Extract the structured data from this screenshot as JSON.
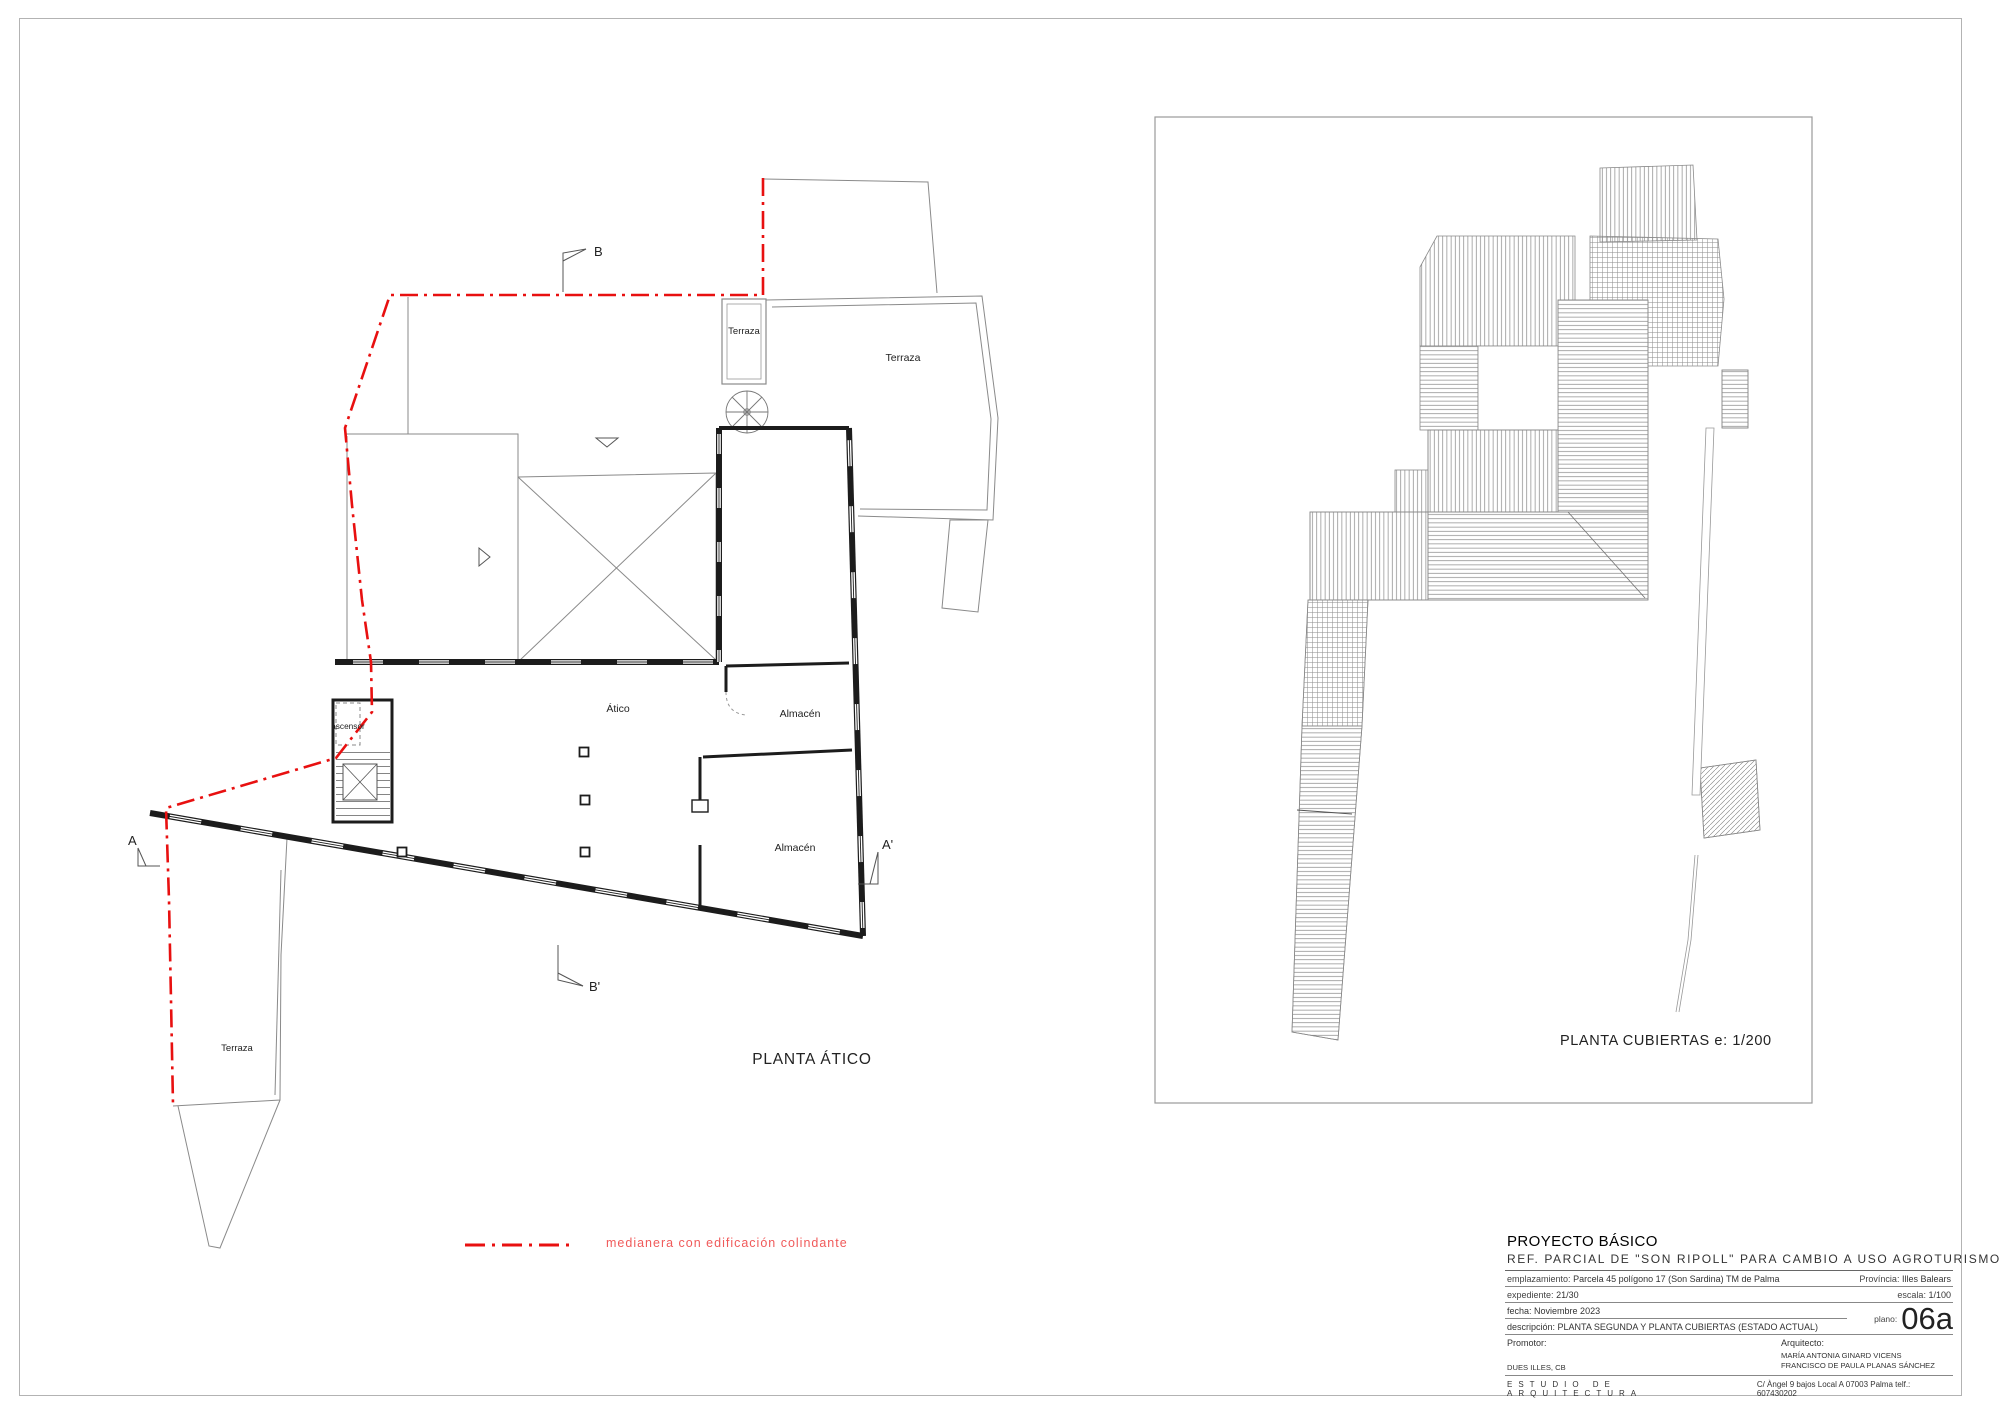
{
  "plan_atico": {
    "title": "PLANTA ÁTICO",
    "labels": {
      "terraza_top": "Terraza",
      "terraza_right": "Terraza",
      "atico": "Ático",
      "almacen_upper": "Almacén",
      "almacen_lower": "Almacén",
      "ascensor": "ascensor",
      "terraza_bottom": "Terraza"
    },
    "section_markers": {
      "a": "A",
      "a_prime": "A'",
      "b": "B",
      "b_prime": "B'"
    }
  },
  "plan_cubiertas": {
    "title": "PLANTA CUBIERTAS  e: 1/200"
  },
  "legend": {
    "label": "medianera con edificación colindante"
  },
  "colors": {
    "boundary_red": "#e81010",
    "legend_text": "#f05a5a"
  },
  "title_block": {
    "project_type": "PROYECTO BÁSICO",
    "project_ref": "REF. PARCIAL DE \"SON RIPOLL\" PARA CAMBIO A USO AGROTURISMO",
    "emplazamiento_label": "emplazamiento:",
    "emplazamiento": "Parcela 45 polígono 17  (Son Sardina) TM de Palma",
    "provincia_label": "Província:",
    "provincia": "Illes Balears",
    "expediente_label": "expediente:",
    "expediente": "21/30",
    "escala_label": "escala:",
    "escala": "1/100",
    "fecha_label": "fecha:",
    "fecha": "Noviembre 2023",
    "descripcion_label": "descripción:",
    "descripcion": "PLANTA SEGUNDA Y PLANTA CUBIERTAS (ESTADO ACTUAL)",
    "plano_label": "plano:",
    "plano": "06a",
    "promotor_label": "Promotor:",
    "promotor": "DUES ILLES, CB",
    "arquitecto_label": "Arquitecto:",
    "arquitecto_1": "MARÍA ANTONIA GINARD VICENS",
    "arquitecto_2": "FRANCISCO DE PAULA PLANAS SÁNCHEZ",
    "estudio": "ESTUDIO DE ARQUITECTURA",
    "estudio_address": "C/ Àngel 9 bajos Local A 07003 Palma telf.: 607430202"
  }
}
